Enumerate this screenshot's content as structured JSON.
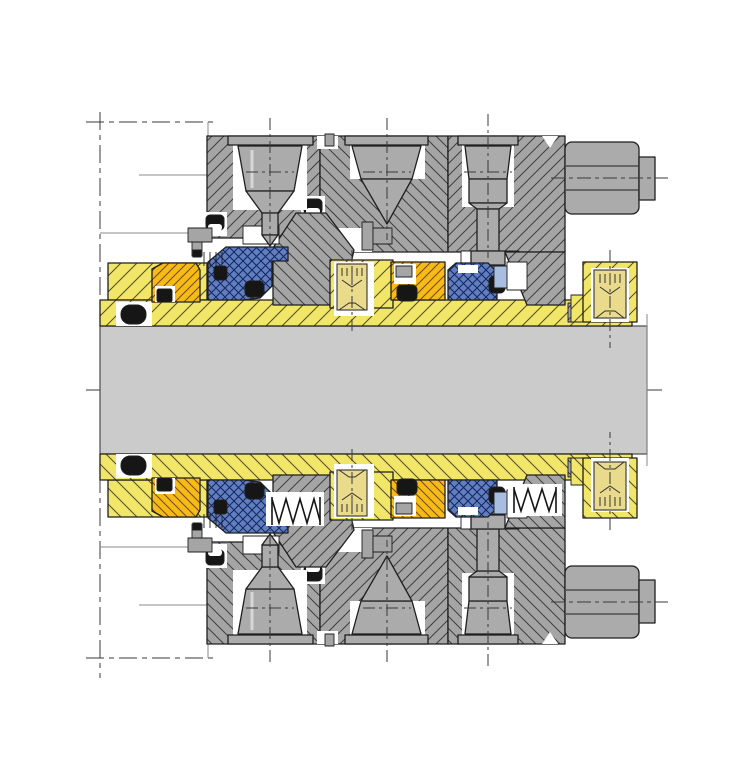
{
  "diagram": {
    "type": "engineering-cross-section",
    "subject": "dual-cartridge-mechanical-seal-on-shaft",
    "text_labels": [],
    "palette": {
      "paper": "#ffffff",
      "line_color": "#1f1f1f",
      "construction_line": "#3a3a3a",
      "sleeve_yellow": "#f2e669",
      "sleeve_hatch": "#55522e",
      "seal_ring_orange": "#f8ba17",
      "orange_hatch": "#6b4c08",
      "bellows_blue": "#5f7fc0",
      "bellows_hatch": "#17245c",
      "follower_blue": "#a9bde0",
      "gland_gray": "#a5a5a5",
      "gland_hatch": "#3f3f3f",
      "light_part_gray": "#b9b9b9",
      "light_part_hatch": "#5f5f5f",
      "screw_gray": "#ababab",
      "setscrew_body": "#e9da8c",
      "shaft_gray": "#cbcbcb",
      "elastomer_black": "#161616"
    },
    "components": [
      "shaft",
      "shaft-centerline",
      "shaft-sleeve",
      "sleeve-flange",
      "gland-plate-inboard",
      "gland-plate-center",
      "gland-plate-outboard",
      "gland-cap-screw",
      "tapered-port-screw",
      "stud-screw",
      "gland-hex-bolt",
      "seal-ring-orange",
      "elastomer-bellows",
      "o-ring",
      "seat-face",
      "drive-collar",
      "socket-set-screw",
      "coil-spring",
      "stuffing-box-outline"
    ]
  }
}
